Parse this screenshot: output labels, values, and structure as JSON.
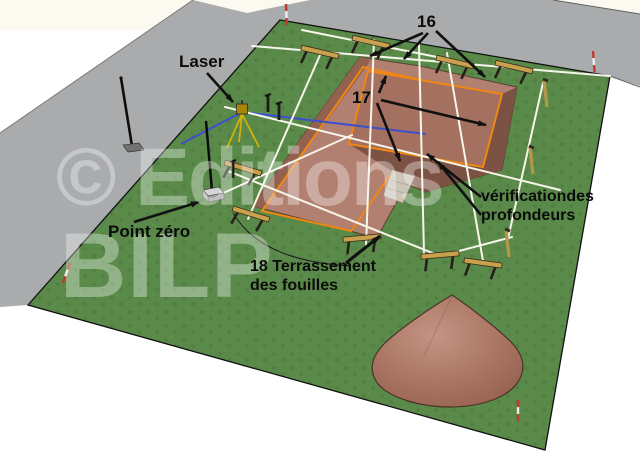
{
  "labels": {
    "laser": "Laser",
    "ref_16": "16",
    "ref_17": "17",
    "verification_line1": "vérificationdes",
    "verification_line2": "profondeurs",
    "terrassement_line1": "18 Terrassement",
    "terrassement_line2": "des fouilles",
    "point_zero": "Point zéro"
  },
  "watermark": {
    "line1": "© Editions",
    "line2": "BILP"
  },
  "colors": {
    "grass": "#5a8a49",
    "grass_dot": "#4f7c3f",
    "road": "#a9abad",
    "earth_light": "#b28070",
    "earth_mid": "#a4705f",
    "earth_dark": "#7c5244",
    "outline_orange": "#ef8712",
    "laser_line_blue": "#3d4fd0",
    "string_white": "#f7f5ea",
    "wood_tan": "#c9a04e",
    "annotation_black": "#111111"
  },
  "scene_elements": [
    "laser-tripod",
    "leveling-staff",
    "point-zero-block",
    "batter-board",
    "string-line",
    "excavation",
    "excavation-outline",
    "access-ramp",
    "spoil-heap",
    "boundary-stake",
    "angle-stake",
    "street-lamp",
    "road",
    "grass-plot"
  ]
}
